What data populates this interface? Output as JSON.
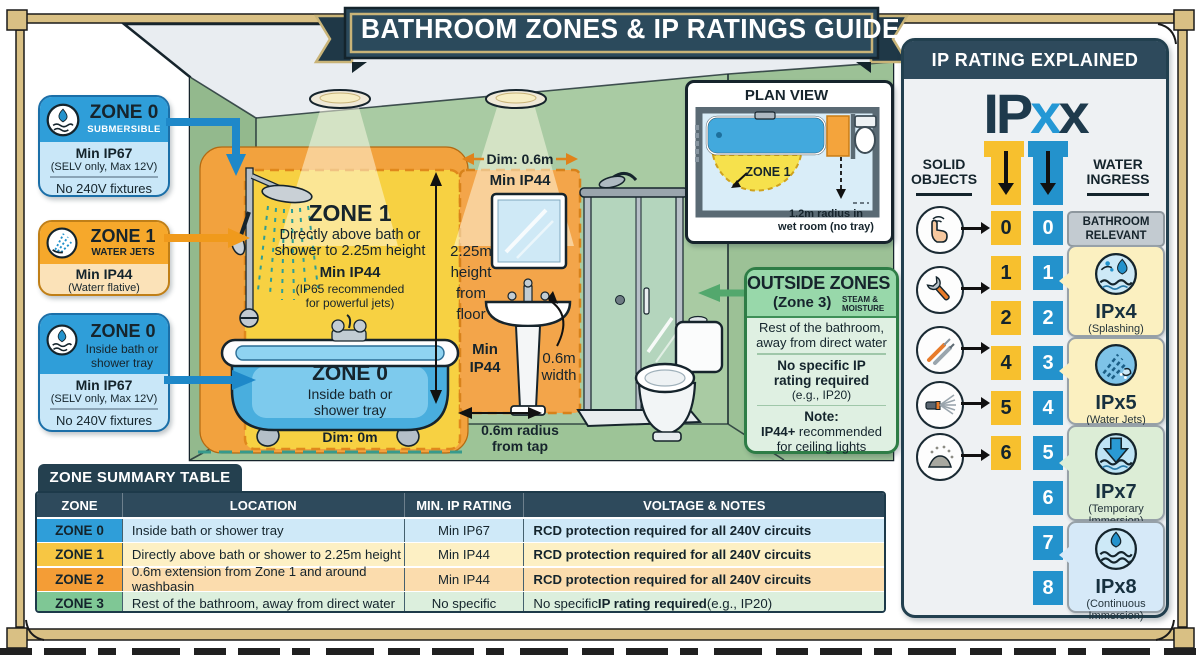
{
  "banner": {
    "title": "BATHROOM ZONES & IP RATINGS GUIDE"
  },
  "callout_zone0_sub": {
    "zone": "ZONE 0",
    "tag": "SUBMERSIBLE",
    "rating": "Min IP67",
    "rating_note": "(SELV only, Max 12V)",
    "restriction": "No 240V fixtures"
  },
  "callout_zone1": {
    "zone": "ZONE 1",
    "tag": "WATER JETS",
    "rating": "Min IP44",
    "rating_note": "(Waterr flative)"
  },
  "callout_zone0_bath": {
    "zone": "ZONE 0",
    "tag": "Inside bath or shower tray",
    "rating": "Min IP67",
    "rating_note": "(SELV only, Max 12V)",
    "restriction": "No 240V fixtures"
  },
  "scene": {
    "zone1_title": "ZONE 1",
    "zone1_line1": "Directly above bath or",
    "zone1_line2": "shower to 2.25m height",
    "zone1_rating": "Min IP44",
    "zone1_note1": "(IP65 recommended",
    "zone1_note2": "for powerful jets)",
    "zone0_title": "ZONE 0",
    "zone0_line1": "Inside bath or",
    "zone0_line2": "shower tray",
    "dim_bath": "Dim: 0m",
    "height1": "2.25m",
    "height2": "height",
    "height3": "from",
    "height4": "floor",
    "dim_basin": "Dim: 0.6m",
    "basin_rating": "Min IP44",
    "min_word": "Min",
    "ip44_word": "IP44",
    "width1": "0.6m",
    "width2": "width",
    "radius1": "0.6m radius",
    "radius2": "from tap"
  },
  "plan": {
    "title": "PLAN VIEW",
    "zone1": "ZONE 1",
    "radius1": "1.2m radius in",
    "radius2": "wet room (no tray)"
  },
  "outside": {
    "title": "OUTSIDE ZONES",
    "subtitle": "(Zone 3)",
    "tag1": "STEAM &",
    "tag2": "MOISTURE",
    "desc1": "Rest of the bathroom,",
    "desc2": "away from direct water",
    "req1": "No specific IP",
    "req2": "rating required",
    "req_eg": "(e.g., IP20)",
    "note_label": "Note:",
    "note_bold": "IP44+",
    "note_rest": " recommended",
    "note_line2": "for ceiling lights"
  },
  "ip_panel": {
    "header": "IP RATING EXPLAINED",
    "ip": "IP",
    "x1": "x",
    "x2": "x",
    "solid_label": "SOLID OBJECTS",
    "water_label": "WATER INGRESS",
    "solid_values": [
      "0",
      "1",
      "2",
      "4",
      "5",
      "6"
    ],
    "water_values": [
      "0",
      "1",
      "2",
      "3",
      "4",
      "5",
      "6",
      "7",
      "8"
    ],
    "relevant": "BATHROOM RELEVANT",
    "ipx4": {
      "code": "IPx4",
      "desc": "(Splashing)"
    },
    "ipx5": {
      "code": "IPx5",
      "desc": "(Water Jets)"
    },
    "ipx7": {
      "code": "IPx7",
      "desc": "(Temporary Immersion)"
    },
    "ipx8": {
      "code": "IPx8",
      "desc": "(Continuous Immersion)"
    }
  },
  "table": {
    "title": "ZONE SUMMARY TABLE",
    "headers": [
      "ZONE",
      "LOCATION",
      "MIN. IP RATING",
      "VOLTAGE & NOTES"
    ],
    "rows": [
      {
        "zone": "ZONE 0",
        "location": "Inside bath or shower tray",
        "rating": "Min IP67",
        "notes_pre": "",
        "notes_bold": "RCD protection required for all 240V circuits",
        "notes_post": ""
      },
      {
        "zone": "ZONE 1",
        "location": "Directly above bath or shower to 2.25m height",
        "rating": "Min IP44",
        "notes_pre": "",
        "notes_bold": "RCD protection required for all 240V circuits",
        "notes_post": ""
      },
      {
        "zone": "ZONE 2",
        "location": "0.6m extension from Zone 1 and around washbasin",
        "rating": "Min IP44",
        "notes_pre": "",
        "notes_bold": "RCD protection required for all 240V circuits",
        "notes_post": ""
      },
      {
        "zone": "ZONE 3",
        "location": "Rest of the bathroom, away from direct water",
        "rating": "No specific",
        "notes_pre": "No specific ",
        "notes_bold": "IP rating required",
        "notes_post": " (e.g., IP20)"
      }
    ]
  },
  "colors": {
    "banner_bg": "#2b4a5c",
    "frame_tan": "#d9c084",
    "zone_blue": "#2f9ed9",
    "zone_yellow": "#f7d142",
    "zone_orange": "#f2a23e",
    "zone_green": "#7fc795",
    "panel_navy": "#2e4a5c",
    "water_blue": "#2392cc",
    "solid_yellow": "#f7c02e"
  }
}
